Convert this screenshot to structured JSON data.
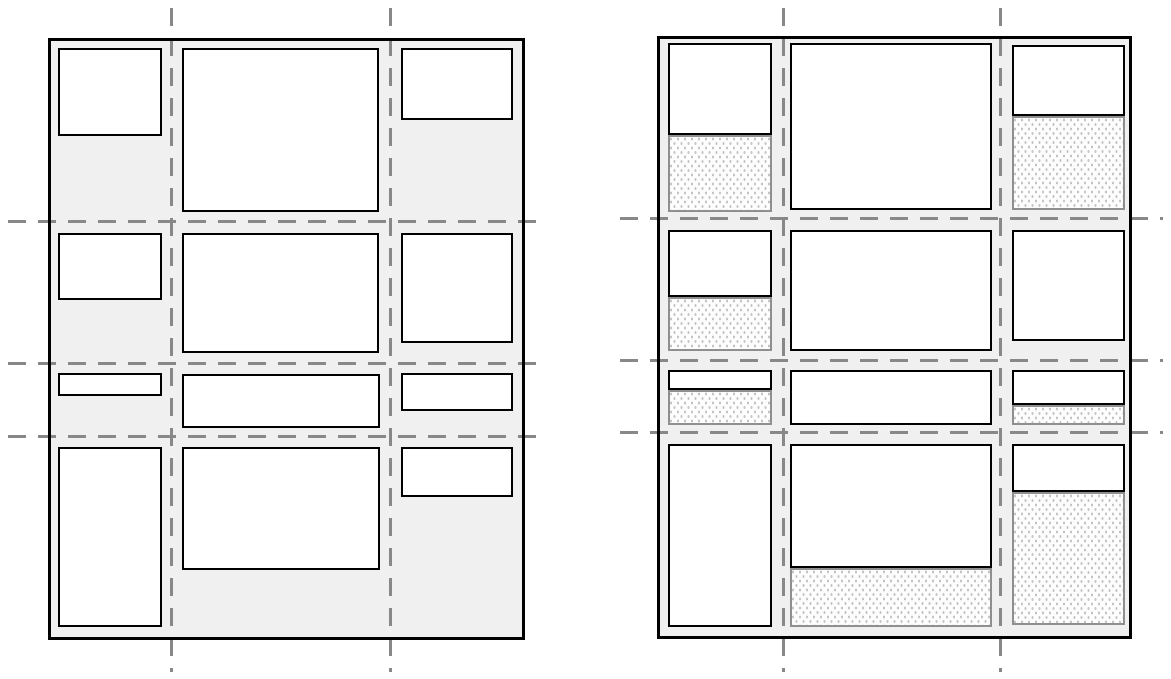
{
  "canvas": {
    "width": 1171,
    "height": 679,
    "background": "#ffffff"
  },
  "colors": {
    "container_fill": "#f0f0f0",
    "container_border": "#000000",
    "item_fill": "#ffffff",
    "item_border": "#000000",
    "grid_line": "#888888",
    "free_space_fill": "#fdfdfd",
    "free_space_border": "#8f8f8f",
    "free_space_dot": "#c4c4c4"
  },
  "strokes": {
    "container_border_width": 3,
    "item_border_width": 2.5,
    "free_space_border_width": 2,
    "grid_line_thickness": 3,
    "dash_length": 18,
    "dash_gap": 12
  },
  "panels": [
    {
      "name": "left-grid-panel",
      "container": {
        "x": 48,
        "y": 38,
        "w": 477,
        "h": 602
      },
      "v_lines": [
        {
          "x": 171,
          "y1": 8,
          "y2": 672
        },
        {
          "x": 390,
          "y1": 8,
          "y2": 672
        }
      ],
      "h_lines": [
        {
          "y": 221,
          "x1": 8,
          "x2": 546
        },
        {
          "y": 363,
          "x1": 8,
          "x2": 546
        },
        {
          "y": 436,
          "x1": 8,
          "x2": 546
        }
      ],
      "items": [
        {
          "x": 58,
          "y": 48,
          "w": 104,
          "h": 88
        },
        {
          "x": 182,
          "y": 48,
          "w": 197,
          "h": 164
        },
        {
          "x": 401,
          "y": 48,
          "w": 112,
          "h": 72
        },
        {
          "x": 58,
          "y": 233,
          "w": 104,
          "h": 67
        },
        {
          "x": 182,
          "y": 233,
          "w": 197,
          "h": 120
        },
        {
          "x": 401,
          "y": 233,
          "w": 112,
          "h": 110
        },
        {
          "x": 58,
          "y": 373,
          "w": 104,
          "h": 23
        },
        {
          "x": 182,
          "y": 374,
          "w": 198,
          "h": 54
        },
        {
          "x": 401,
          "y": 373,
          "w": 112,
          "h": 38
        },
        {
          "x": 58,
          "y": 447,
          "w": 104,
          "h": 180
        },
        {
          "x": 182,
          "y": 447,
          "w": 198,
          "h": 123
        },
        {
          "x": 401,
          "y": 447,
          "w": 112,
          "h": 50
        }
      ],
      "free_spaces": []
    },
    {
      "name": "right-grid-panel",
      "container": {
        "x": 657,
        "y": 36,
        "w": 475,
        "h": 603
      },
      "v_lines": [
        {
          "x": 783,
          "y1": 8,
          "y2": 672
        },
        {
          "x": 1000,
          "y1": 8,
          "y2": 672
        }
      ],
      "h_lines": [
        {
          "y": 218,
          "x1": 620,
          "x2": 1163
        },
        {
          "y": 360,
          "x1": 620,
          "x2": 1163
        },
        {
          "y": 432,
          "x1": 620,
          "x2": 1163
        }
      ],
      "items": [
        {
          "x": 668,
          "y": 43,
          "w": 104,
          "h": 92
        },
        {
          "x": 790,
          "y": 43,
          "w": 202,
          "h": 167
        },
        {
          "x": 1012,
          "y": 45,
          "w": 113,
          "h": 71
        },
        {
          "x": 668,
          "y": 230,
          "w": 104,
          "h": 67
        },
        {
          "x": 790,
          "y": 230,
          "w": 202,
          "h": 121
        },
        {
          "x": 1012,
          "y": 230,
          "w": 113,
          "h": 111
        },
        {
          "x": 668,
          "y": 370,
          "w": 104,
          "h": 20
        },
        {
          "x": 790,
          "y": 370,
          "w": 202,
          "h": 55
        },
        {
          "x": 1012,
          "y": 370,
          "w": 113,
          "h": 35
        },
        {
          "x": 668,
          "y": 444,
          "w": 104,
          "h": 183
        },
        {
          "x": 790,
          "y": 444,
          "w": 202,
          "h": 124
        },
        {
          "x": 1012,
          "y": 444,
          "w": 113,
          "h": 48
        }
      ],
      "free_spaces": [
        {
          "x": 668,
          "y": 135,
          "w": 104,
          "h": 77
        },
        {
          "x": 1012,
          "y": 116,
          "w": 113,
          "h": 94
        },
        {
          "x": 668,
          "y": 297,
          "w": 104,
          "h": 54
        },
        {
          "x": 668,
          "y": 390,
          "w": 104,
          "h": 35
        },
        {
          "x": 1012,
          "y": 405,
          "w": 113,
          "h": 20
        },
        {
          "x": 790,
          "y": 568,
          "w": 202,
          "h": 59
        },
        {
          "x": 1012,
          "y": 492,
          "w": 113,
          "h": 133
        }
      ]
    }
  ]
}
